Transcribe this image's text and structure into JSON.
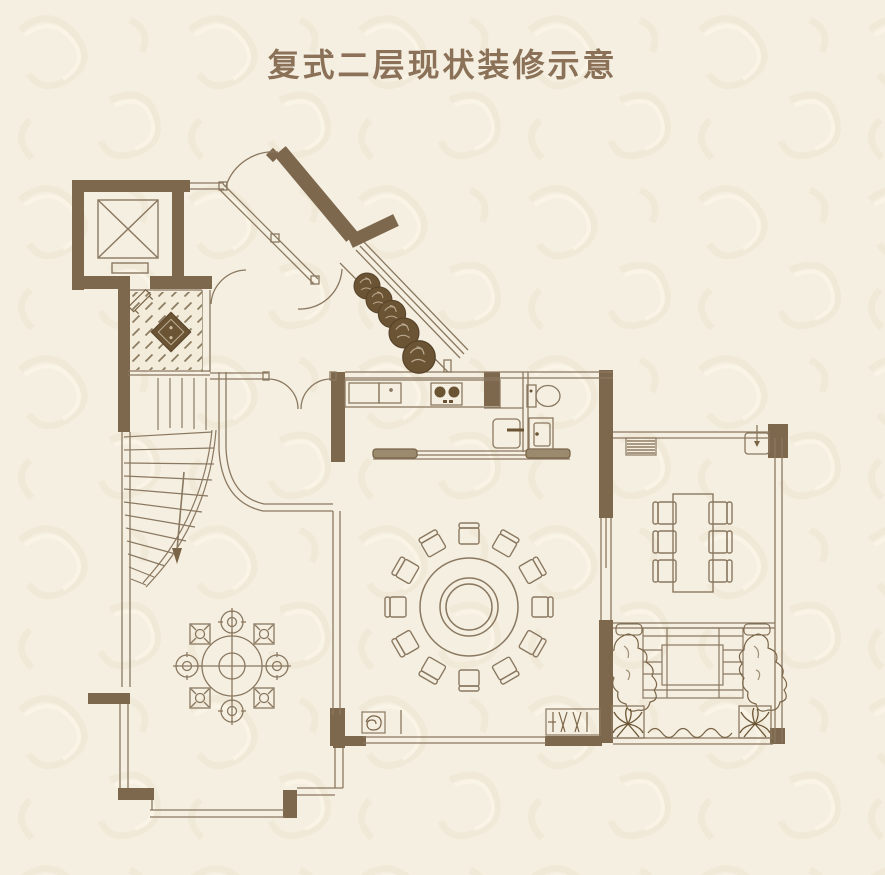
{
  "title": "复式二层现状装修示意",
  "colors": {
    "background": "#f5efe1",
    "pattern": "#ece2cc",
    "wall": "#7d684d",
    "line": "#8a7860",
    "title_text": "#8a7158",
    "plant": "#6b5434"
  },
  "plan": {
    "rooms": [
      "elevator",
      "entry-foyer",
      "curved-staircase",
      "entry-vestibule",
      "kitchen",
      "bathroom",
      "dining-area",
      "sun-room",
      "terrace",
      "tea-room",
      "bay-window"
    ],
    "fixtures": {
      "elevator_symbol": "crossed-box",
      "foyer_floor": "diagonal-hatch with diamond medallion",
      "planter_shrubs_count": 5,
      "round_dining_table_chairs": 12,
      "rect_table_chairs": 6,
      "tea_table_stools": 8,
      "palm_planters": 2,
      "stove_burners": 2,
      "bath_fixtures": [
        "toilet",
        "basin-cabinet",
        "shower-box"
      ],
      "ac_units": [
        "striped-unit-sunroom",
        "hatched-unit-dining"
      ]
    }
  }
}
